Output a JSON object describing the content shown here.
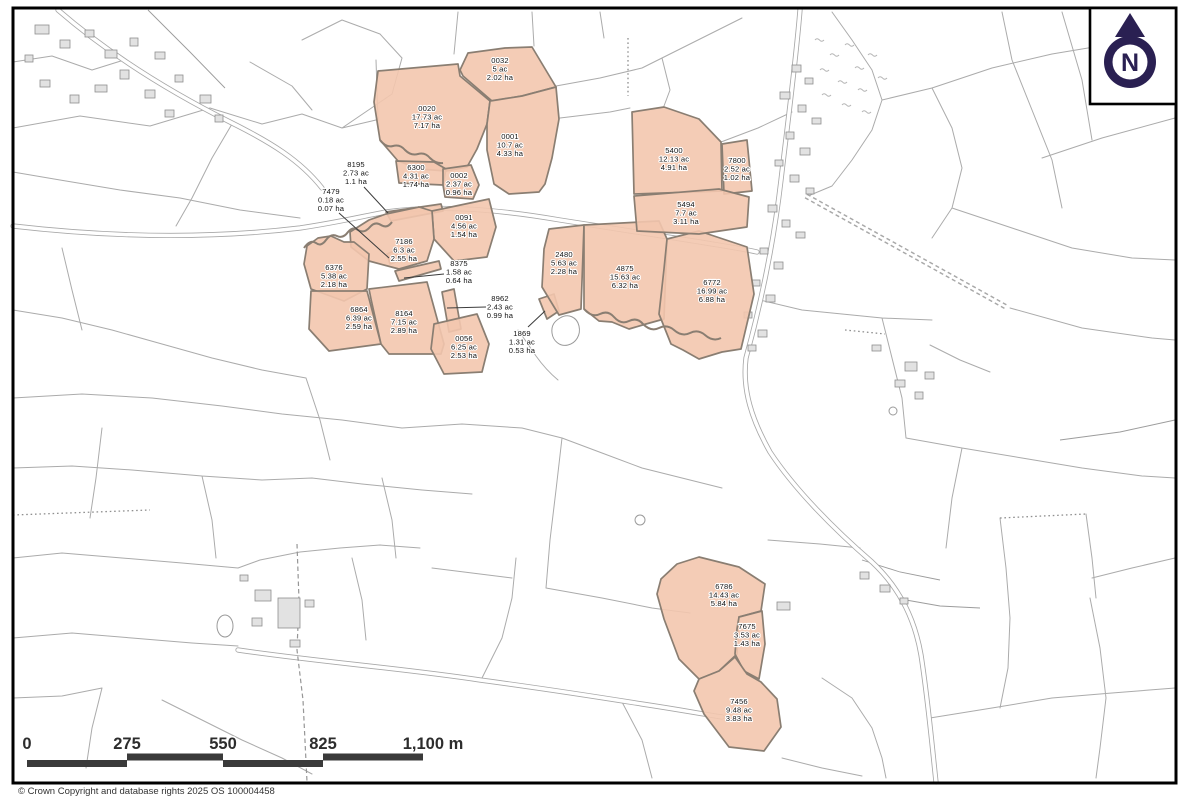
{
  "north": {
    "label": "N"
  },
  "footer": {
    "copyright": "© Crown Copyright and database rights 2025 OS 100004458"
  },
  "scale_bar": {
    "tick_labels": [
      "0",
      "275",
      "550",
      "825",
      "1,100 m"
    ]
  },
  "colors": {
    "parcel_fill": "#f3c7ae",
    "parcel_stroke": "#8a7e72",
    "north_arrow": "#2a2052",
    "scale_bar": "#3a3a3a",
    "boundary_line": "#ababab"
  },
  "parcels": [
    {
      "id": "0032",
      "area_ac": "5 ac",
      "area_ha": "2.02 ha",
      "label": {
        "x": 500,
        "y": 63
      },
      "points": "460,70 468,53 505,48 532,47 556,87 522,96 492,101 463,76"
    },
    {
      "id": "0020",
      "area_ac": "17.73 ac",
      "area_ha": "7.17 ha",
      "label": {
        "x": 427,
        "y": 111
      },
      "points": "378,71 458,64 460,76 490,101 487,124 477,149 467,167 446,171 420,169 398,161 380,140 374,102"
    },
    {
      "id": "0001",
      "area_ac": "10.7 ac",
      "area_ha": "4.33 ha",
      "label": {
        "x": 510,
        "y": 139
      },
      "points": "490,101 522,96 556,87 559,119 552,158 545,184 539,192 509,194 494,184 487,150 487,124"
    },
    {
      "id": "6300",
      "area_ac": "4.31 ac",
      "area_ha": "1.74 ha",
      "label": {
        "x": 416,
        "y": 170
      },
      "points": "396,161 434,162 446,169 443,185 399,183"
    },
    {
      "id": "0002",
      "area_ac": "2.37 ac",
      "area_ha": "0.96 ha",
      "label": {
        "x": 459,
        "y": 178
      },
      "points": "443,169 471,165 479,185 473,199 445,197 443,185"
    },
    {
      "id": "8195",
      "area_ac": "2.73 ac",
      "area_ha": "1.1 ha",
      "label": {
        "x": 356,
        "y": 167
      },
      "leader": [
        364,
        187,
        388,
        213
      ],
      "points": "386,212 441,204 443,211 391,221"
    },
    {
      "id": "7479",
      "area_ac": "0.18 ac",
      "area_ha": "0.07 ha",
      "label": {
        "x": 331,
        "y": 194
      },
      "leader": [
        339,
        213,
        389,
        258
      ],
      "points": "387,254 396,250 399,261 390,264"
    },
    {
      "id": "0091",
      "area_ac": "4.56 ac",
      "area_ha": "1.54 ha",
      "label": {
        "x": 464,
        "y": 220
      },
      "points": "432,211 489,199 496,227 487,257 454,261 434,239"
    },
    {
      "id": "7186",
      "area_ac": "6.3 ac",
      "area_ha": "2.55 ha",
      "label": {
        "x": 404,
        "y": 244
      },
      "points": "350,232 369,220 386,214 419,207 432,211 434,239 427,261 399,269 369,261 351,247"
    },
    {
      "id": "8375",
      "area_ac": "1.58 ac",
      "area_ha": "0.64 ha",
      "label": {
        "x": 459,
        "y": 266
      },
      "leader": [
        444,
        274,
        404,
        278
      ],
      "points": "395,271 439,261 441,269 399,281"
    },
    {
      "id": "6376",
      "area_ac": "5.38 ac",
      "area_ha": "2.18 ha",
      "label": {
        "x": 334,
        "y": 270
      },
      "points": "307,246 318,238 331,236 344,242 354,242 369,254 367,289 344,301 311,289 304,264"
    },
    {
      "id": "6864",
      "area_ac": "6.39 ac",
      "area_ha": "2.59 ha",
      "label": {
        "x": 359,
        "y": 312
      },
      "points": "311,291 367,291 381,344 329,351 309,329"
    },
    {
      "id": "8164",
      "area_ac": "7.15 ac",
      "area_ha": "2.89 ha",
      "label": {
        "x": 404,
        "y": 316
      },
      "points": "369,289 427,282 444,344 441,354 389,354 381,344 371,299"
    },
    {
      "id": "8962",
      "area_ac": "2.43 ac",
      "area_ha": "0.99 ha",
      "label": {
        "x": 500,
        "y": 301
      },
      "leader": [
        486,
        307,
        447,
        308
      ],
      "points": "442,292 454,289 461,329 449,332"
    },
    {
      "id": "0056",
      "area_ac": "6.25 ac",
      "area_ha": "2.53 ha",
      "label": {
        "x": 464,
        "y": 341
      },
      "points": "434,324 477,314 489,344 482,372 444,374 431,349"
    },
    {
      "id": "1869",
      "area_ac": "1.31 ac",
      "area_ha": "0.53 ha",
      "label": {
        "x": 522,
        "y": 336
      },
      "leader": [
        528,
        327,
        545,
        311
      ],
      "points": "539,299 554,294 559,311 547,319"
    },
    {
      "id": "2480",
      "area_ac": "5.63 ac",
      "area_ha": "2.28 ha",
      "label": {
        "x": 564,
        "y": 257
      },
      "points": "549,229 584,225 581,309 559,315 542,287 544,249"
    },
    {
      "id": "4875",
      "area_ac": "15.63 ac",
      "area_ha": "6.32 ha",
      "label": {
        "x": 625,
        "y": 271
      },
      "points": "584,225 659,221 667,239 664,319 646,324 629,329 612,322 599,321 584,309"
    },
    {
      "id": "6772",
      "area_ac": "16.99 ac",
      "area_ha": "6.88 ha",
      "label": {
        "x": 712,
        "y": 285
      },
      "points": "667,239 699,231 747,247 754,294 741,349 722,352 699,359 683,350 671,344 659,314 664,269"
    },
    {
      "id": "5400",
      "area_ac": "12.13 ac",
      "area_ha": "4.91 ha",
      "label": {
        "x": 674,
        "y": 153
      },
      "points": "632,112 664,107 699,119 721,142 722,191 634,194"
    },
    {
      "id": "7800",
      "area_ac": "2.52 ac",
      "area_ha": "1.02 ha",
      "label": {
        "x": 737,
        "y": 163
      },
      "points": "722,144 747,140 752,191 724,194"
    },
    {
      "id": "5494",
      "area_ac": "7.7 ac",
      "area_ha": "3.11 ha",
      "label": {
        "x": 686,
        "y": 207
      },
      "points": "634,196 719,189 749,197 747,227 699,234 637,231"
    },
    {
      "id": "6786",
      "area_ac": "14.43 ac",
      "area_ha": "5.84 ha",
      "label": {
        "x": 724,
        "y": 589
      },
      "points": "661,579 677,564 699,557 739,567 765,584 761,611 739,617 737,654 719,671 699,679 679,659 664,619 657,594"
    },
    {
      "id": "7675",
      "area_ac": "3.53 ac",
      "area_ha": "1.43 ha",
      "label": {
        "x": 747,
        "y": 629
      },
      "points": "739,617 762,611 765,644 759,679 744,671 735,654 737,629"
    },
    {
      "id": "7456",
      "area_ac": "9.48 ac",
      "area_ha": "3.83 ha",
      "label": {
        "x": 739,
        "y": 704
      },
      "points": "699,679 719,671 735,657 747,674 761,682 777,699 781,727 764,751 729,747 704,714 694,691"
    }
  ]
}
